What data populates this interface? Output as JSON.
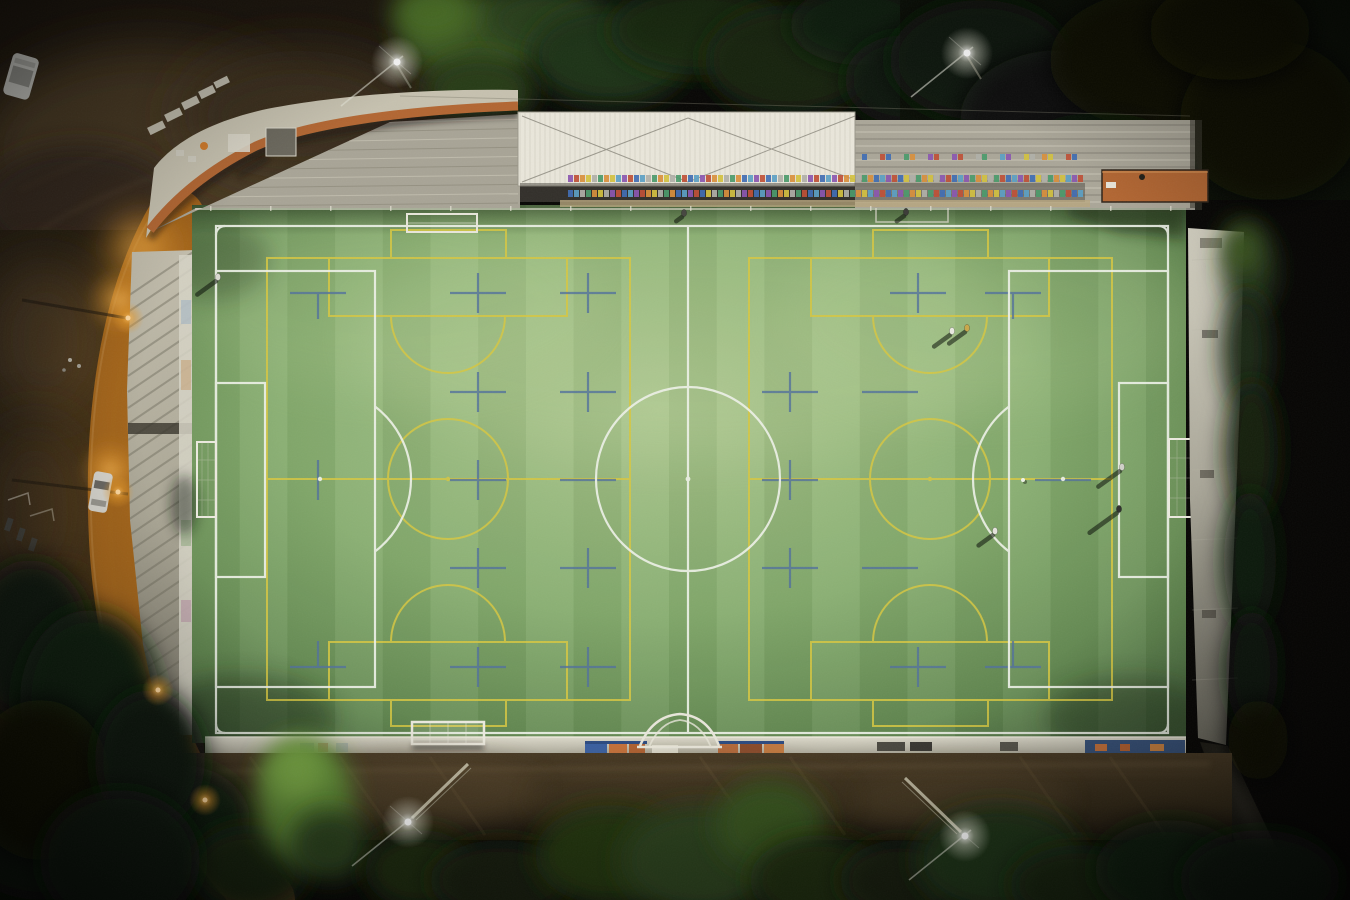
{
  "scene": {
    "type": "aerial-night-photo",
    "description": "Top-down drone photo at night of a floodlit artificial-turf football pitch: white 11-a-side markings, two yellow cross pitches, blue training crosses, roofed grandstand with multicolored seats at top, terracotta-roofed clubhouse terrace top-left, orange sodium-lit street on the left, white perimeter wall and earth bank at the bottom, dark trees all around"
  },
  "colors": {
    "background": "#070604",
    "turf_bright": "#a8c48a",
    "turf_mid": "#7fa868",
    "turf_dark": "#41603a",
    "line_white": "#edf1e7",
    "line_yellow": "#d6c742",
    "line_blue": "#52719c",
    "road_asphalt": "#9a5d18",
    "road_glow": "#e69a2c",
    "walkway_concrete": "#b5b0a0",
    "stand_concrete": "#a8a496",
    "roof_white": "#e9e6da",
    "terracotta_roof": "#b26632",
    "perimeter_wall": "#cfccbd",
    "embankment": "#3f3320",
    "tree_dark": "#101a09",
    "tree_lit": "#5f8c36",
    "seat_palette": [
      "#bf4f35",
      "#d98f3b",
      "#3f6db3",
      "#d3c13f",
      "#5aa0c4",
      "#b0b0a8",
      "#8a56b0",
      "#4a9a6a"
    ]
  },
  "field": {
    "main_pitch": "white full-size pitch with centre circle, penalty areas, goal areas, penalty arcs, corner arcs",
    "cross_pitches": "two yellow cross pitches with centre circles and penalty boxes",
    "training_marks": "grid of small blue crosses"
  },
  "people": [
    {
      "x": 218,
      "y": 277,
      "shirt": "#d9d9d0",
      "shadow": 26
    },
    {
      "x": 684,
      "y": 213,
      "shirt": "#45453f",
      "shadow": 8
    },
    {
      "x": 906,
      "y": 212,
      "shirt": "#3a3a36",
      "shadow": 10
    },
    {
      "x": 952,
      "y": 331,
      "shirt": "#e9e9e0",
      "shadow": 22
    },
    {
      "x": 967,
      "y": 328,
      "shirt": "#c9a84a",
      "shadow": 22
    },
    {
      "x": 1122,
      "y": 467,
      "shirt": "#d0d0c8",
      "shadow": 30
    },
    {
      "x": 1119,
      "y": 509,
      "shirt": "#2e2e2c",
      "shadow": 38
    },
    {
      "x": 995,
      "y": 531,
      "shirt": "#e4e4dc",
      "shadow": 20
    }
  ],
  "balls": [
    {
      "x": 1023,
      "y": 480
    }
  ],
  "floodlights": [
    {
      "id": "top-left",
      "x": 397,
      "y": 62
    },
    {
      "id": "top-right",
      "x": 967,
      "y": 53
    },
    {
      "id": "bottom-left",
      "x": 408,
      "y": 822
    },
    {
      "id": "bottom-right",
      "x": 965,
      "y": 836
    }
  ],
  "street": {
    "lamps": [
      {
        "x": 128,
        "y": 318
      },
      {
        "x": 118,
        "y": 492
      },
      {
        "x": 158,
        "y": 690
      },
      {
        "x": 205,
        "y": 800
      }
    ]
  }
}
